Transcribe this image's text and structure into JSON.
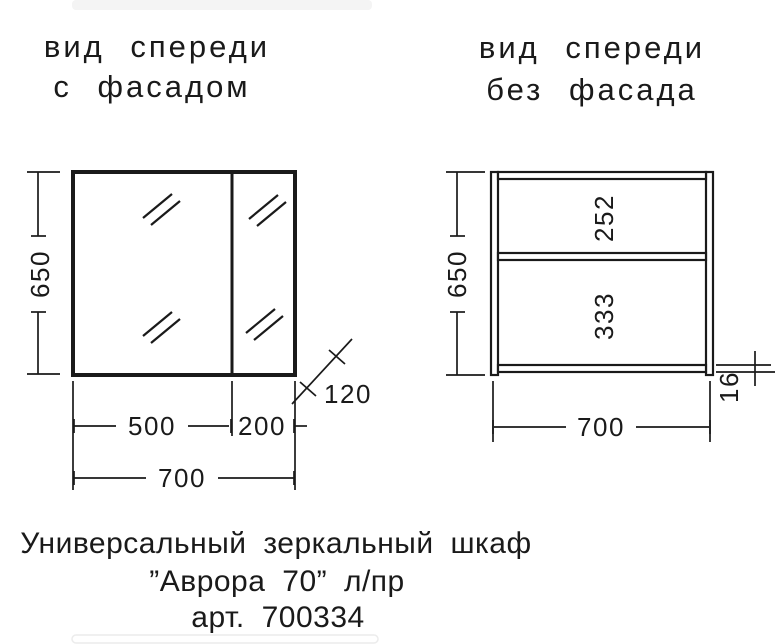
{
  "page": {
    "background": "#ffffff",
    "line_color": "#1a1a1a"
  },
  "left_view": {
    "title_line1": "вид спереди",
    "title_line2": "с фасадом",
    "height_dim": "650",
    "door_width_dim": "500",
    "side_width_dim": "200",
    "total_width_dim": "700",
    "depth_dim": "120"
  },
  "right_view": {
    "title_line1": "вид спереди",
    "title_line2": "без фасада",
    "height_dim": "650",
    "upper_compartment_dim": "252",
    "lower_compartment_dim": "333",
    "width_dim": "700",
    "panel_thickness_dim": "16"
  },
  "caption": {
    "line1": "Универсальный зеркальный шкаф",
    "line2": "”Аврора 70” л/пр",
    "line3": "арт. 700334"
  }
}
